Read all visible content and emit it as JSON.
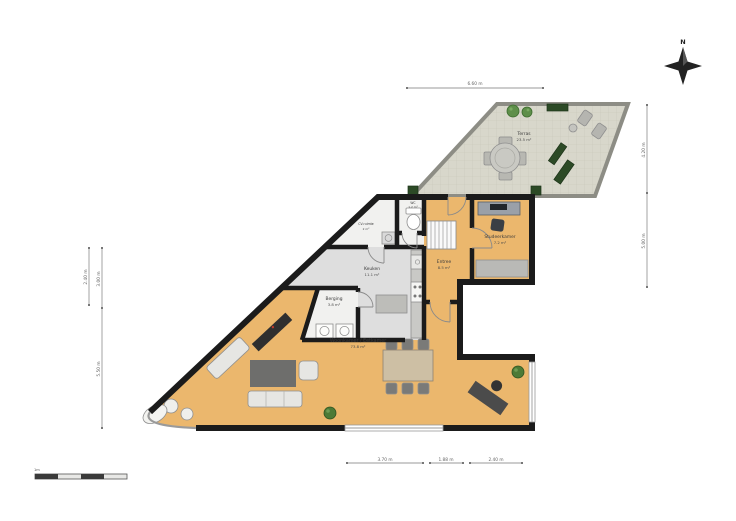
{
  "plan_title": "Floor plan ground floor",
  "compass": {
    "label": "N"
  },
  "rooms": {
    "terras": {
      "name": "Terras",
      "area": "23.5 m²"
    },
    "wc": {
      "name": "WC",
      "area": "1.2 m²"
    },
    "cv": {
      "name": "CV-ruimte",
      "area": "2 m²"
    },
    "keuken": {
      "name": "Keuken",
      "area": "11.1 m²"
    },
    "berging": {
      "name": "Berging",
      "area": "3.8 m²"
    },
    "entree": {
      "name": "Entree",
      "area": "8.5 m²"
    },
    "studeerkamer": {
      "name": "Studeerkamer",
      "area": "7.2 m²"
    },
    "woonkamer": {
      "name": "Woonkamer / Eetkamer",
      "area": "73.8 m²"
    }
  },
  "dimensions": {
    "top": "6.60 m",
    "right_upper": "4.20 m",
    "right_lower": "5.00 m",
    "left_outer": "2.40 m",
    "left_inner_upper": "3.00 m",
    "left_inner_lower": "5.50 m",
    "bottom_left": "3.70 m",
    "bottom_middle": "1.88 m",
    "bottom_right": "2.40 m"
  },
  "scale_bar": {
    "label": "1m"
  },
  "colors": {
    "wall": "#1b1b1b",
    "floor_main": "#ebb76d",
    "floor_kitchen": "#dedede",
    "floor_utility": "#f1f1ef",
    "floor_terrace": "#d8d7cb",
    "plant_green": "#4c7a36",
    "planter_green": "#2c4a26",
    "furniture_gray": "#c6c6c2",
    "furniture_dark": "#4b4b4b"
  }
}
